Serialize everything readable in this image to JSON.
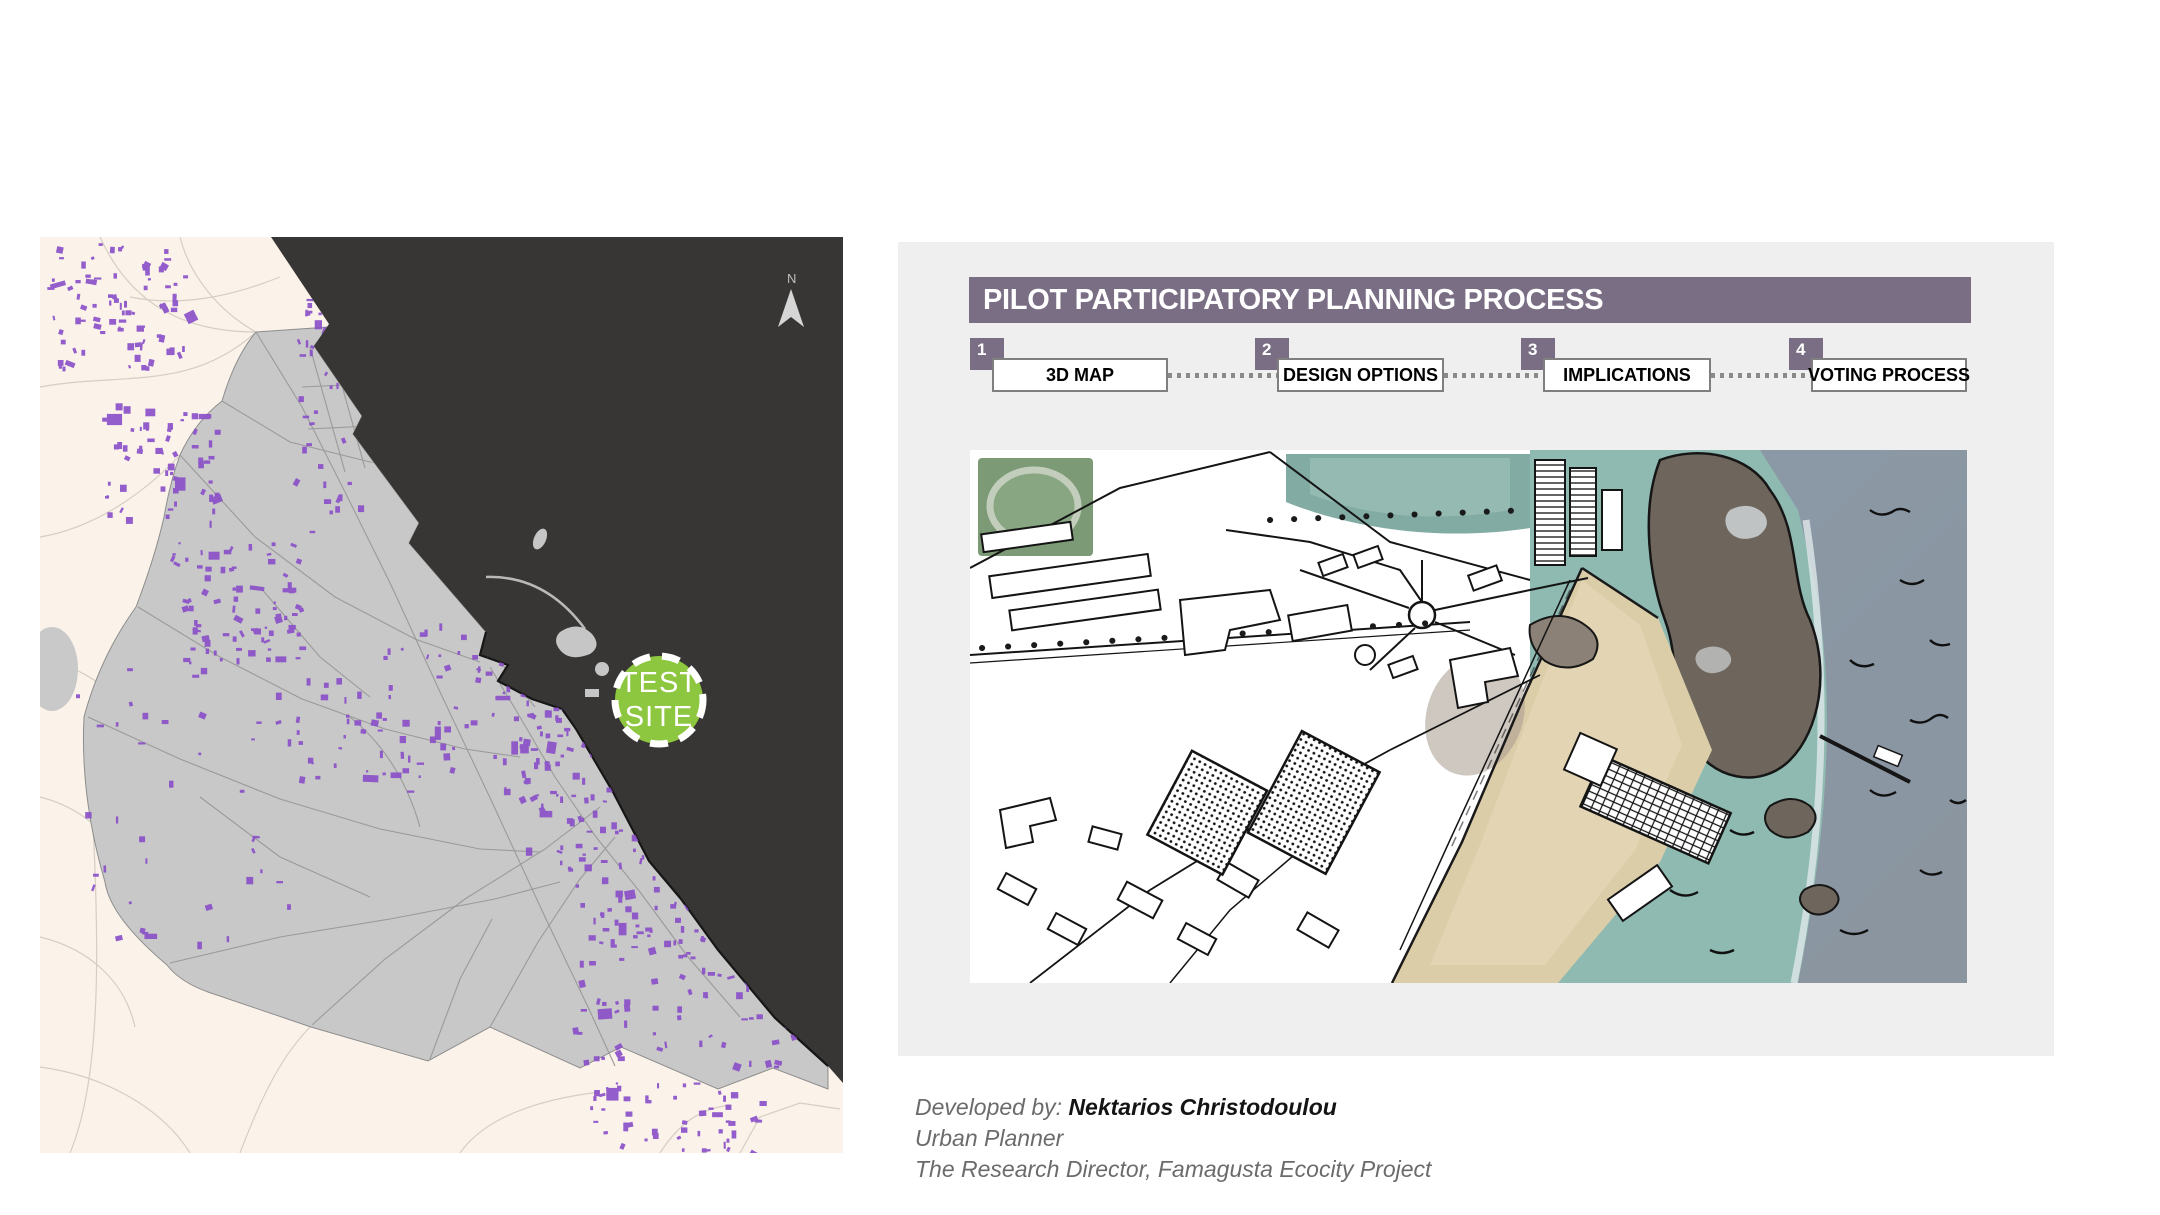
{
  "map": {
    "test_site_line1": "TEST",
    "test_site_line2": "SITE",
    "north_label": "N",
    "colors": {
      "land_cream": "#fbf3ea",
      "sea_dark": "#383634",
      "urban_gray": "#c8c8c8",
      "building_purple": "#8a50c8",
      "site_green": "#8dc63f"
    }
  },
  "process": {
    "title": "PILOT PARTICIPATORY PLANNING PROCESS",
    "header_color": "#7a6e84",
    "panel_background": "#f0eff0",
    "steps": [
      {
        "num": "1",
        "label": "3D MAP"
      },
      {
        "num": "2",
        "label": "DESIGN OPTIONS"
      },
      {
        "num": "3",
        "label": "IMPLICATIONS"
      },
      {
        "num": "4",
        "label": "VOTING PROCESS"
      }
    ]
  },
  "illustration_colors": {
    "sea_blue": "#8b99a6",
    "shallow_teal": "#8fbab2",
    "sand": "#dccda9",
    "rock": "#6e665d",
    "park_green": "#7d9a76"
  },
  "credits": {
    "developed_by_label": "Developed by: ",
    "developer_name": "Nektarios Christodoulou",
    "role": "Urban Planner",
    "affiliation": "The Research Director, Famagusta Ecocity Project"
  }
}
